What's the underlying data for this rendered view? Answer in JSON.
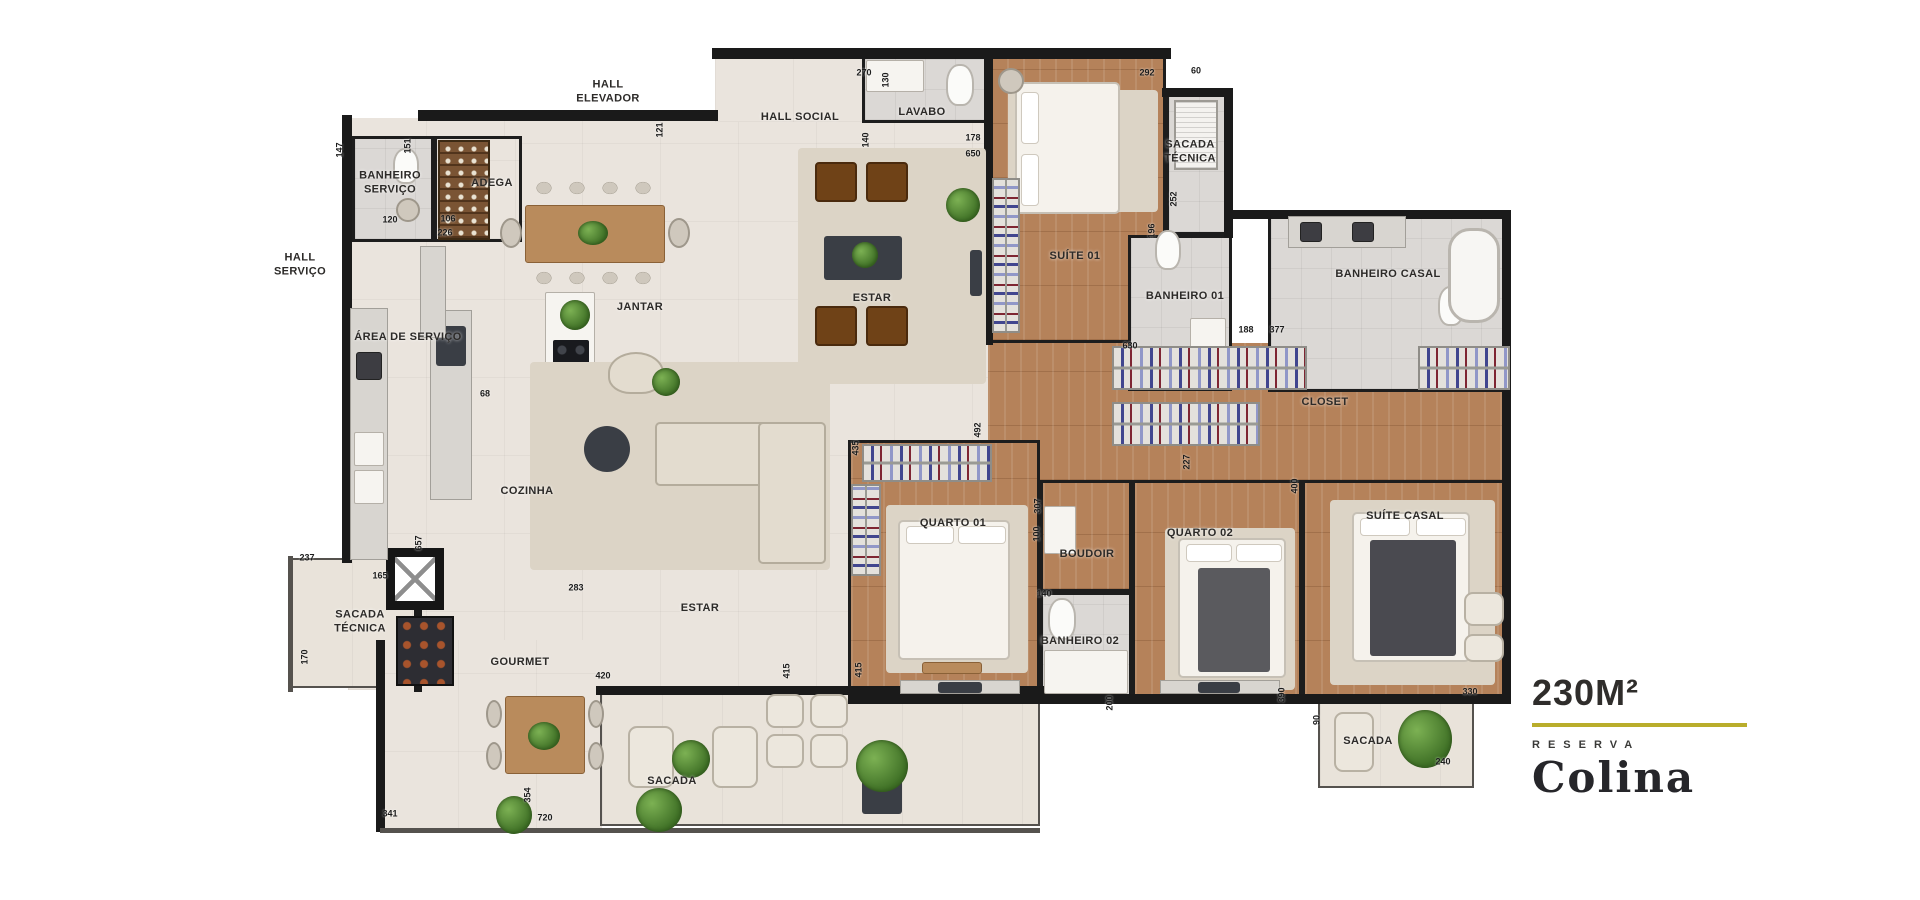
{
  "logo": {
    "area": "230M²",
    "reserva": "RESERVA",
    "colina": "Colina"
  },
  "palette": {
    "wall": "#1a1a1a",
    "wood": "#b5825a",
    "cream": "#eae4dd",
    "bath": "#dbd8d5",
    "balcony": "#e9e3da",
    "accent_rule": "#b9ad2b",
    "label": "#2c2a28"
  },
  "plan": {
    "labels": [
      {
        "text": "HALL\nELEVADOR",
        "x": 608,
        "y": 92
      },
      {
        "text": "HALL SOCIAL",
        "x": 800,
        "y": 117
      },
      {
        "text": "LAVABO",
        "x": 922,
        "y": 112
      },
      {
        "text": "BANHEIRO\nSERVIÇO",
        "x": 390,
        "y": 183
      },
      {
        "text": "ADEGA",
        "x": 492,
        "y": 183
      },
      {
        "text": "HALL\nSERVIÇO",
        "x": 300,
        "y": 265
      },
      {
        "text": "ÁREA DE SERVIÇO",
        "x": 408,
        "y": 337
      },
      {
        "text": "JANTAR",
        "x": 640,
        "y": 307
      },
      {
        "text": "ESTAR",
        "x": 872,
        "y": 298
      },
      {
        "text": "SUÍTE 01",
        "x": 1075,
        "y": 256
      },
      {
        "text": "SACADA\nTÉCNICA",
        "x": 1190,
        "y": 152
      },
      {
        "text": "BANHEIRO 01",
        "x": 1185,
        "y": 296
      },
      {
        "text": "BANHEIRO CASAL",
        "x": 1388,
        "y": 274
      },
      {
        "text": "CLOSET",
        "x": 1325,
        "y": 402
      },
      {
        "text": "COZINHA",
        "x": 527,
        "y": 491
      },
      {
        "text": "SACADA\nTÉCNICA",
        "x": 360,
        "y": 622
      },
      {
        "text": "ESTAR",
        "x": 700,
        "y": 608
      },
      {
        "text": "GOURMET",
        "x": 520,
        "y": 662
      },
      {
        "text": "QUARTO 01",
        "x": 953,
        "y": 523
      },
      {
        "text": "BOUDOIR",
        "x": 1087,
        "y": 554
      },
      {
        "text": "BANHEIRO 02",
        "x": 1080,
        "y": 641
      },
      {
        "text": "QUARTO 02",
        "x": 1200,
        "y": 533
      },
      {
        "text": "SUÍTE CASAL",
        "x": 1405,
        "y": 516
      },
      {
        "text": "SACADA",
        "x": 672,
        "y": 781
      },
      {
        "text": "SACADA",
        "x": 1368,
        "y": 741
      }
    ],
    "dimensions": [
      {
        "text": "147",
        "x": 340,
        "y": 150,
        "v": true
      },
      {
        "text": "151",
        "x": 408,
        "y": 146,
        "v": true
      },
      {
        "text": "120",
        "x": 390,
        "y": 220,
        "v": false
      },
      {
        "text": "106",
        "x": 448,
        "y": 219,
        "v": false
      },
      {
        "text": "226",
        "x": 445,
        "y": 233,
        "v": false
      },
      {
        "text": "121",
        "x": 660,
        "y": 130,
        "v": true
      },
      {
        "text": "270",
        "x": 864,
        "y": 73,
        "v": false
      },
      {
        "text": "130",
        "x": 886,
        "y": 80,
        "v": true
      },
      {
        "text": "140",
        "x": 866,
        "y": 140,
        "v": true
      },
      {
        "text": "178",
        "x": 973,
        "y": 138,
        "v": false
      },
      {
        "text": "650",
        "x": 973,
        "y": 154,
        "v": false
      },
      {
        "text": "292",
        "x": 1147,
        "y": 73,
        "v": false
      },
      {
        "text": "60",
        "x": 1196,
        "y": 71,
        "v": false
      },
      {
        "text": "252",
        "x": 1174,
        "y": 199,
        "v": true
      },
      {
        "text": "196",
        "x": 1152,
        "y": 231,
        "v": true
      },
      {
        "text": "188",
        "x": 1246,
        "y": 330,
        "v": false
      },
      {
        "text": "377",
        "x": 1277,
        "y": 330,
        "v": false
      },
      {
        "text": "630",
        "x": 1130,
        "y": 346,
        "v": false
      },
      {
        "text": "68",
        "x": 485,
        "y": 394,
        "v": false
      },
      {
        "text": "657",
        "x": 419,
        "y": 543,
        "v": true
      },
      {
        "text": "237",
        "x": 307,
        "y": 558,
        "v": false
      },
      {
        "text": "165",
        "x": 380,
        "y": 576,
        "v": false
      },
      {
        "text": "170",
        "x": 305,
        "y": 657,
        "v": true
      },
      {
        "text": "283",
        "x": 576,
        "y": 588,
        "v": false
      },
      {
        "text": "420",
        "x": 603,
        "y": 676,
        "v": false
      },
      {
        "text": "341",
        "x": 390,
        "y": 814,
        "v": false
      },
      {
        "text": "354",
        "x": 528,
        "y": 795,
        "v": true
      },
      {
        "text": "720",
        "x": 545,
        "y": 818,
        "v": false
      },
      {
        "text": "492",
        "x": 978,
        "y": 430,
        "v": true
      },
      {
        "text": "435",
        "x": 856,
        "y": 448,
        "v": true
      },
      {
        "text": "227",
        "x": 1187,
        "y": 462,
        "v": true
      },
      {
        "text": "400",
        "x": 1295,
        "y": 486,
        "v": true
      },
      {
        "text": "307",
        "x": 1038,
        "y": 506,
        "v": true
      },
      {
        "text": "100",
        "x": 1037,
        "y": 534,
        "v": true
      },
      {
        "text": "140",
        "x": 1044,
        "y": 594,
        "v": false
      },
      {
        "text": "415",
        "x": 787,
        "y": 671,
        "v": true
      },
      {
        "text": "415",
        "x": 859,
        "y": 670,
        "v": true
      },
      {
        "text": "200",
        "x": 1110,
        "y": 703,
        "v": true
      },
      {
        "text": "390",
        "x": 1282,
        "y": 695,
        "v": true
      },
      {
        "text": "330",
        "x": 1470,
        "y": 692,
        "v": false
      },
      {
        "text": "90",
        "x": 1317,
        "y": 720,
        "v": true
      },
      {
        "text": "240",
        "x": 1443,
        "y": 762,
        "v": false
      }
    ]
  }
}
